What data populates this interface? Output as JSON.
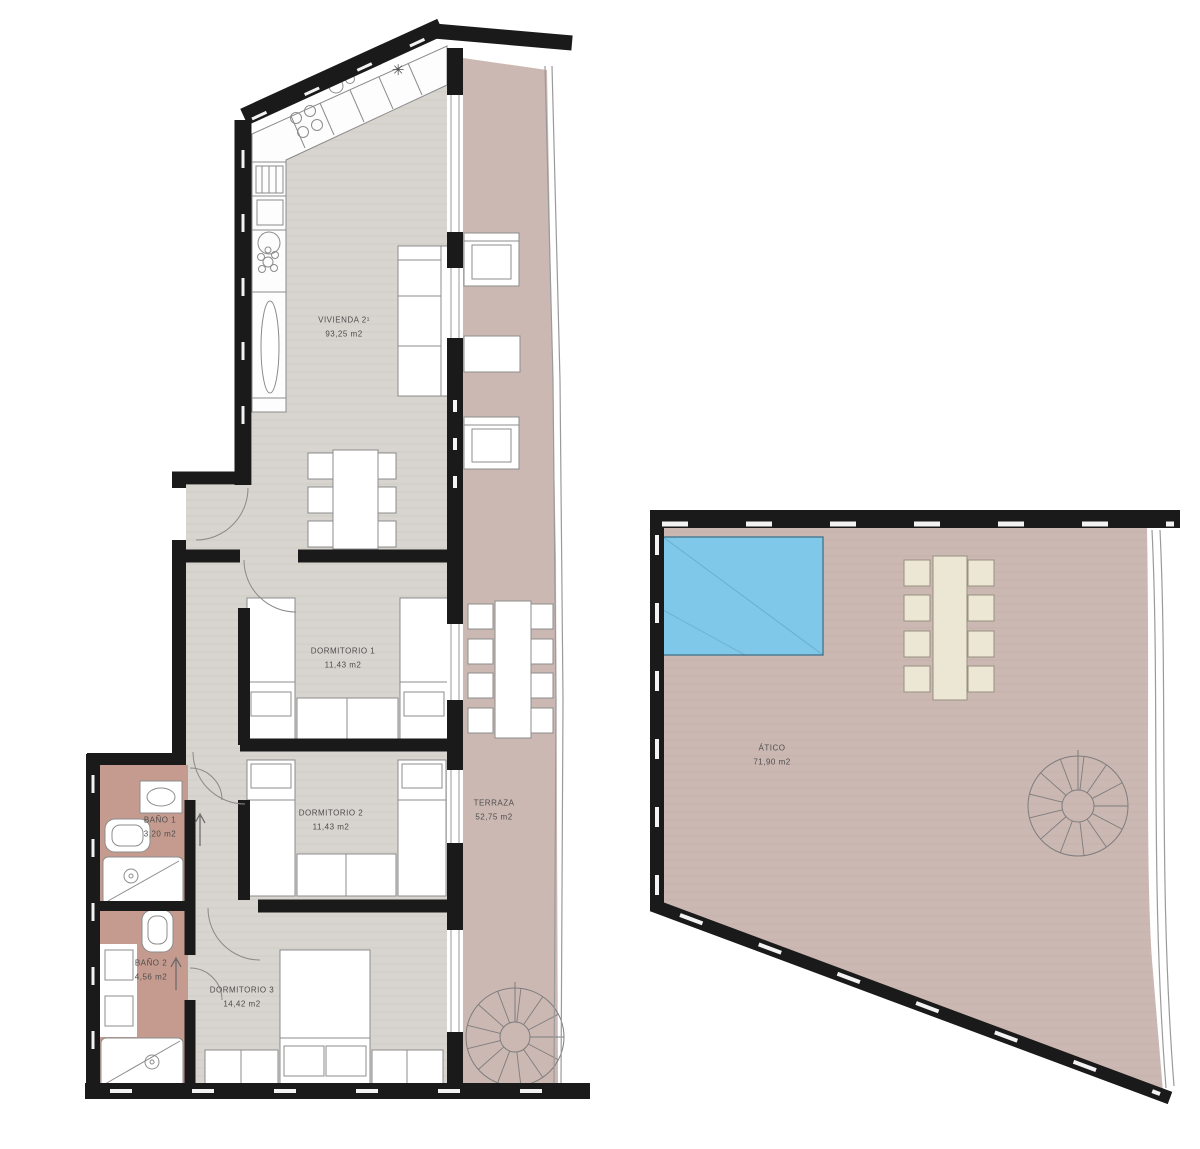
{
  "title": "floor-plan",
  "colors": {
    "background": "#ffffff",
    "wall": "#1a1a1a",
    "floor": "#d8d4cf",
    "terrace": "#ccb8b3",
    "bath": "#c59b8f",
    "pool": "#7fc8ea",
    "cream": "#ece6d4",
    "line": "#8c8c8c",
    "label_text": "#4d4d4d"
  },
  "rooms": {
    "vivienda": {
      "name": "VIVIENDA 2¹",
      "area": "93,25 m2"
    },
    "dormitorio1": {
      "name": "DORMITORIO 1",
      "area": "11,43 m2"
    },
    "dormitorio2": {
      "name": "DORMITORIO 2",
      "area": "11,43 m2"
    },
    "dormitorio3": {
      "name": "DORMITORIO 3",
      "area": "14,42 m2"
    },
    "bano1": {
      "name": "BAÑO 1",
      "area": "3,20 m2"
    },
    "bano2": {
      "name": "BAÑO 2",
      "area": "4,56 m2"
    },
    "terraza": {
      "name": "TERRAZA",
      "area": "52,75 m2"
    },
    "atico": {
      "name": "ÁTICO",
      "area": "71,90 m2"
    }
  },
  "symbols": {
    "kitchen_star": "✳"
  }
}
